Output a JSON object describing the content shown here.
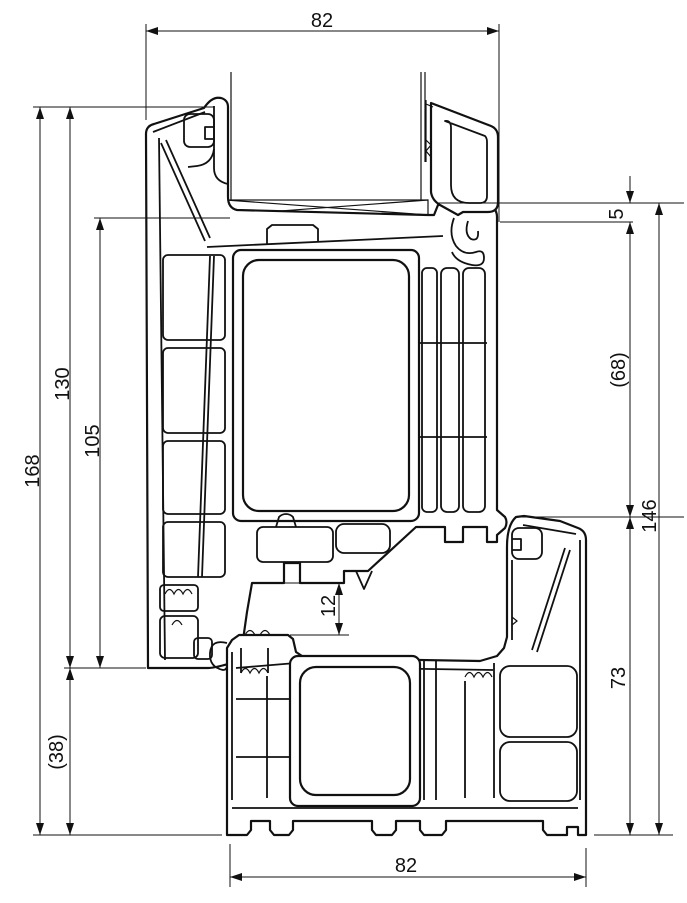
{
  "drawing": {
    "type": "technical-cross-section",
    "subject": "PVC window frame and sash profile section",
    "background_color": "#ffffff",
    "line_color": "#111111",
    "dims": {
      "top_width": "82",
      "bottom_width": "82",
      "overall_height": "168",
      "sash_height": "130",
      "sash_inner_height": "105",
      "lower_extension": "(38)",
      "gap_top": "5",
      "sash_overlap": "(68)",
      "frame_total_height": "146",
      "frame_height": "73",
      "rebate_step": "12"
    }
  }
}
